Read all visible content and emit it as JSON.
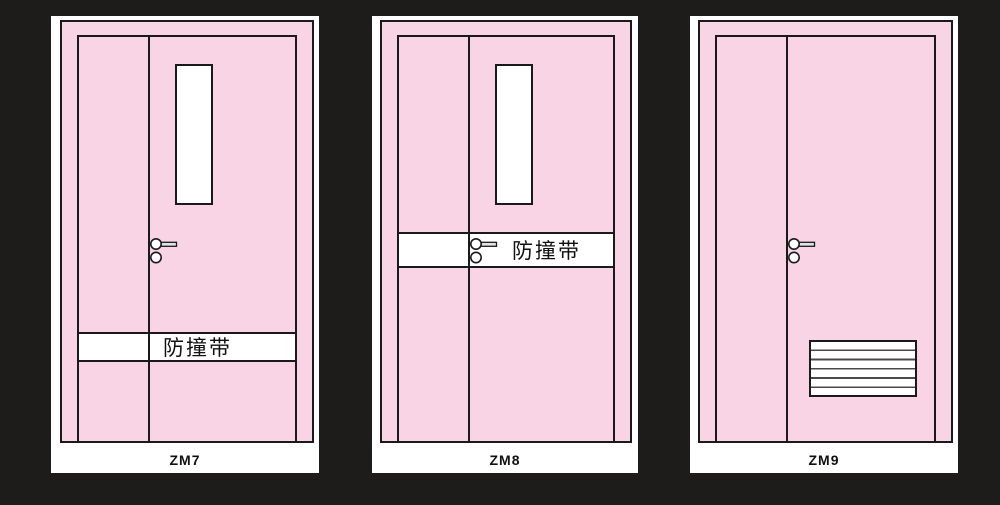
{
  "colors": {
    "bg": "#1e1b1b",
    "pink": "#f8d4e4",
    "line": "#1a1a1a",
    "panel-bg": "#ffffff"
  },
  "panels": [
    {
      "label": "ZM7",
      "band_label": "防撞带"
    },
    {
      "label": "ZM8",
      "band_label": "防撞带"
    },
    {
      "label": "ZM9"
    }
  ]
}
